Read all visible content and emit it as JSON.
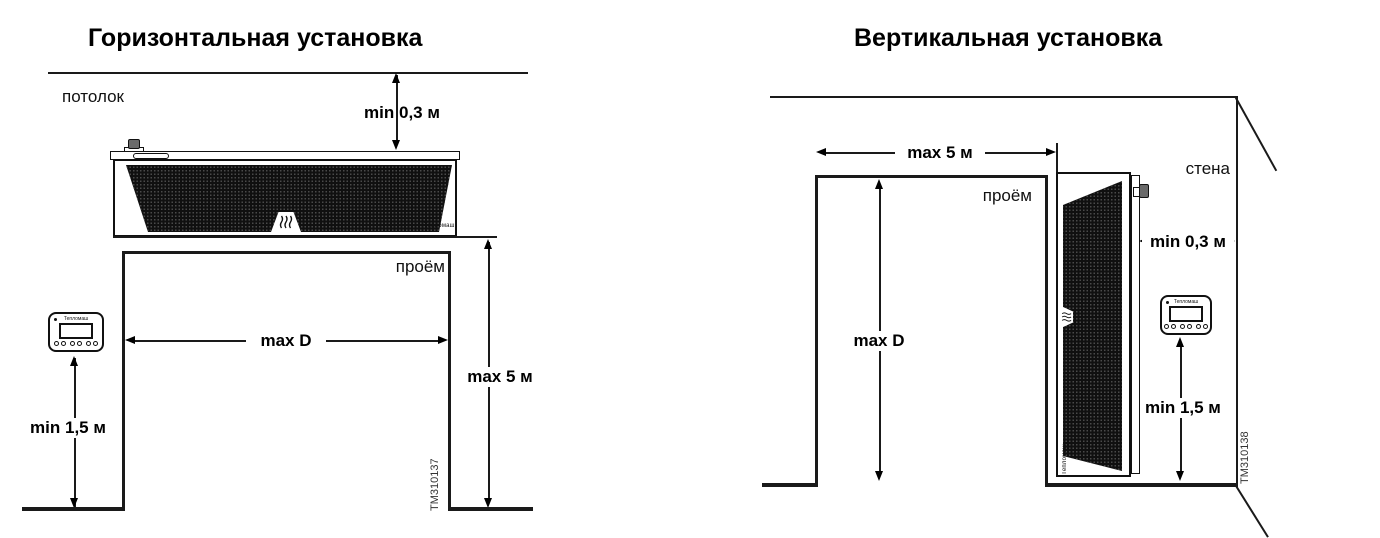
{
  "brand": "Тепломаш",
  "left_diagram": {
    "title": "Горизонтальная установка",
    "ceiling_label": "потолок",
    "opening_label": "проём",
    "dim_ceiling_clearance": "min 0,3 м",
    "dim_opening_width": "max D",
    "dim_opening_height": "max 5 м",
    "dim_controller_height": "min 1,5 м",
    "drawing_id": "TM310137"
  },
  "right_diagram": {
    "title": "Вертикальная установка",
    "wall_label": "стена",
    "opening_label": "проём",
    "dim_wall_clearance": "min 0,3 м",
    "dim_opening_height": "max D",
    "dim_opening_width": "max 5 м",
    "dim_controller_height": "min 1,5 м",
    "drawing_id": "TM310138"
  }
}
